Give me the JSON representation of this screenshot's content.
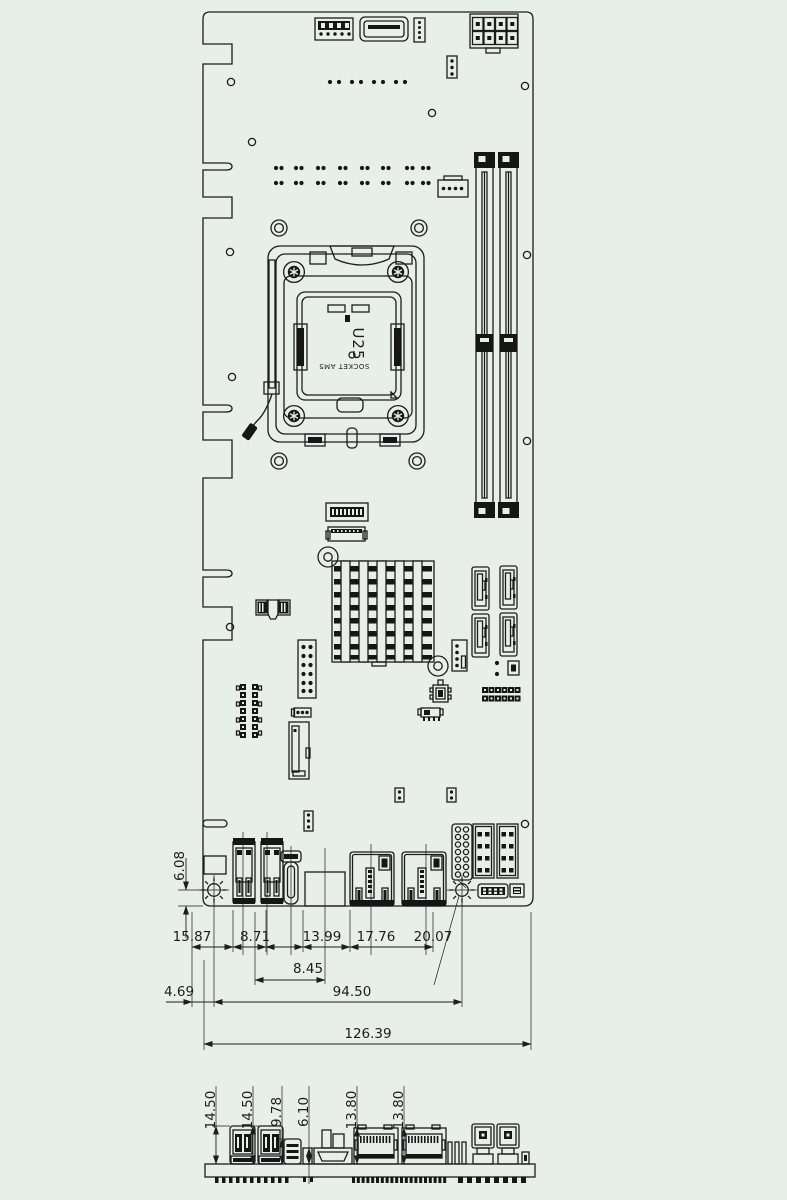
{
  "drawing": {
    "colors": {
      "background": "#e8eee8",
      "line": "#1d1d1d",
      "dark_fill": "#161616"
    },
    "cpu_socket": {
      "designator": "U25",
      "socket_label": "SOCKET AM5",
      "latch_label": "REMOVE"
    },
    "top_view": {
      "dim_hole_edge": "6.08",
      "dim_chain": [
        "15.87",
        "8.71",
        "13.99",
        "17.76",
        "20.07"
      ],
      "dim_8_45": "8.45",
      "dim_4_69": "4.69",
      "dim_94_50": "94.50",
      "dim_overall": "126.39"
    },
    "side_view": {
      "dims": [
        "14.50",
        "14.50",
        "9.78",
        "6.10",
        "13.80",
        "13.80"
      ]
    }
  }
}
